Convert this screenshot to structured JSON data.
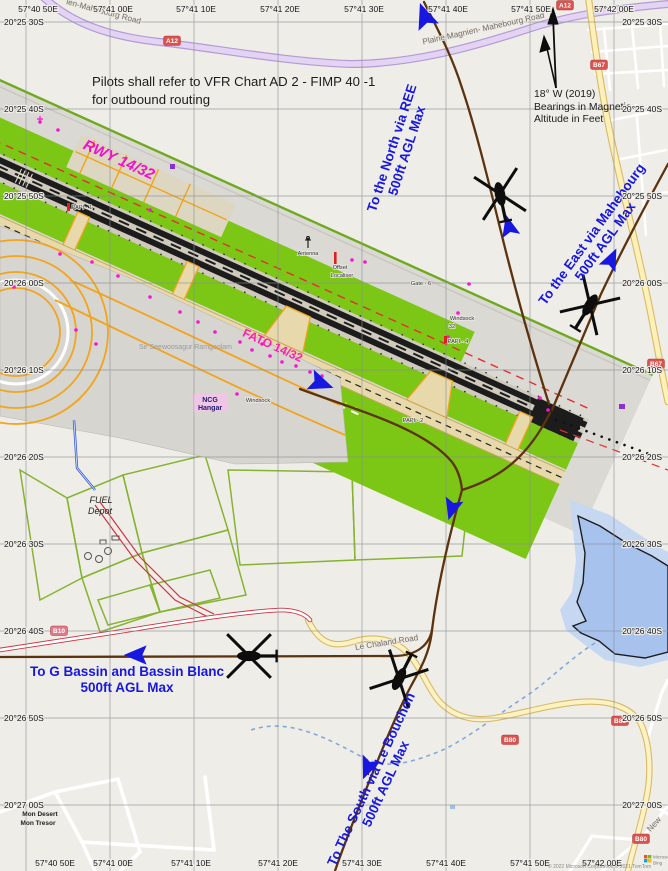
{
  "notice": {
    "line1": "Pilots shall refer to VFR Chart AD 2 - FIMP 40 -1",
    "line2": "for outbound routing"
  },
  "magnetic_note": {
    "variation": "18° W (2019)",
    "bearings": "Bearings in Magnetic",
    "altitude": "Altitude in Feet"
  },
  "airport": {
    "runway_label": "RWY 14/32",
    "fato_label": "FATO 14/32",
    "name_label": "Sir Seewoosagur Ramgoolam",
    "papi1": "PAPI - 1",
    "papi2": "PAPI - 2",
    "papi4": "PAPI - 4",
    "windsock_a": "Windsock",
    "windsock_b_line1": "Windsock",
    "windsock_b_line2": "32",
    "gate6": "Gate - 6",
    "antenna": "Antenna",
    "offset_loc_line1": "Offset",
    "offset_loc_line2": "Localiser",
    "ncg_line1": "NCG",
    "ncg_line2": "Hangar",
    "fuel_line1": "FUEL",
    "fuel_line2": "Depot"
  },
  "routes": {
    "north": {
      "label": "To the North via REE",
      "altitude": "500ft AGL Max"
    },
    "east": {
      "label": "To the East via Mahebourg",
      "altitude": "500ft AGL Max"
    },
    "west": {
      "label": "To G Bassin and  Bassin Blanc",
      "altitude": "500ft AGL Max"
    },
    "south": {
      "label": "To The South via Le Bouchon",
      "altitude": "500ft AGL Max"
    }
  },
  "roads": {
    "a12_top": "A12",
    "a12_right": "A12",
    "b67_upper": "B67",
    "b67_lower": "B67",
    "b10": "B10",
    "b80_west": "B80",
    "b86": "B86",
    "b80_south": "B80",
    "plaine_road": "Plaine Magnien- Mahebourg Road",
    "plaine_road_partial": "ien-Mahebourg Road",
    "chaland_road": "Le Chaland Road",
    "new_road": "New"
  },
  "places": {
    "mon_desert_line1": "Mon Desert",
    "mon_desert_line2": "Mon Tresor"
  },
  "grid": {
    "top": [
      "57°40 50E",
      "57°41 00E",
      "57°41 10E",
      "57°41 20E",
      "57°41 30E",
      "57°41 40E",
      "57°41 50E",
      "57°42 00E"
    ],
    "bottom": [
      "57°40 50E",
      "57°41 00E",
      "57°41 10E",
      "57°41 20E",
      "57°41 30E",
      "57°41 40E",
      "57°41 50E",
      "57°42 00E"
    ],
    "left": [
      "20°25 30S",
      "20°25 40S",
      "20°25 50S",
      "20°26 00S",
      "20°26 10S",
      "20°26 20S",
      "20°26 30S",
      "20°26 40S",
      "20°26 50S",
      "20°27 00S"
    ],
    "right": [
      "20°25 30S",
      "20°25 40S",
      "20°25 50S",
      "20°26 00S",
      "20°26 10S",
      "20°26 20S",
      "20°26 30S",
      "20°26 40S",
      "20°26 50S",
      "20°27 00S"
    ]
  },
  "attribution": {
    "copyright": "© 2022 Microsoft Corporation © 2021 TomTom",
    "logo_line1": "Microsoft",
    "logo_line2": "Bing"
  },
  "colors": {
    "route_brown": "#5c330f",
    "route_label_blue": "#1717e0",
    "runway_magenta": "#ee12cb",
    "water": "#a8c2ee",
    "grass": "#7cc616",
    "badge_red": "#d9534f"
  }
}
